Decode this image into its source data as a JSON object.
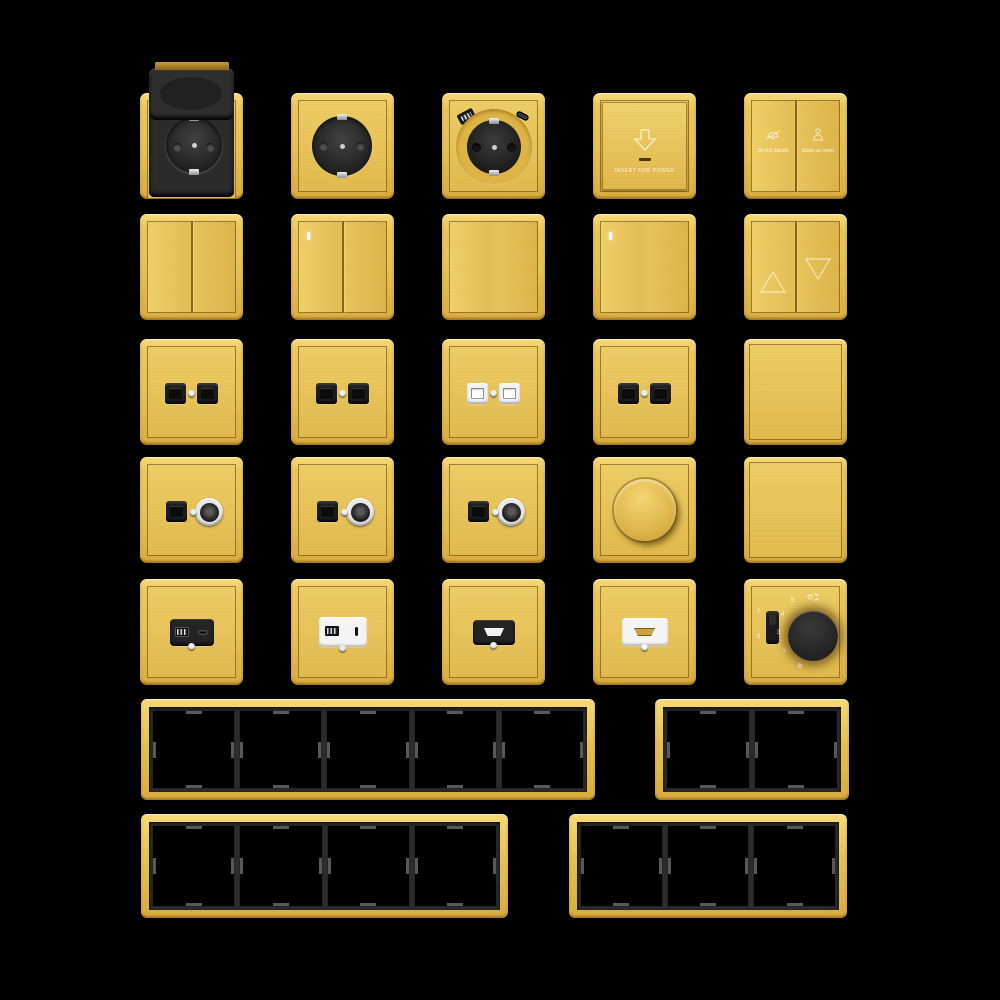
{
  "palette": {
    "background": "#000000",
    "gold": "#E8C355",
    "gold_light": "#F6D977",
    "gold_dark": "#D9AC3E",
    "seam_brown": "#8A6516",
    "module_black": "#242424",
    "module_white": "#F4F4F4",
    "frame_window_black": "#000000",
    "divider_gray": "#585858",
    "indicator_white": "#FFFFFF"
  },
  "icons": {
    "arrow_down": "insert-card down arrow outline",
    "bell_slash": "do-not-disturb icon",
    "maid": "make-up-room icon",
    "triangle_up": "curtain up",
    "triangle_down": "curtain down",
    "fan": "fan symbol",
    "snowflake": "cool symbol"
  },
  "products": [
    {
      "name": "schuko-socket-flip-cover"
    },
    {
      "name": "schuko-socket"
    },
    {
      "name": "schuko-socket-usb-charger"
    },
    {
      "name": "key-card-power-switch",
      "label": "INSERT FOR POWER"
    },
    {
      "name": "service-switch",
      "left_label": "Do not disturb",
      "right_label": "Make up room"
    },
    {
      "name": "rocker-switch-2-gang"
    },
    {
      "name": "rocker-switch-2-gang-indicator"
    },
    {
      "name": "rocker-switch-1-gang"
    },
    {
      "name": "rocker-switch-1-gang-indicator"
    },
    {
      "name": "curtain-blind-switch"
    },
    {
      "name": "data-socket-2-port-black"
    },
    {
      "name": "data-socket-2-port-black"
    },
    {
      "name": "data-socket-2-port-white"
    },
    {
      "name": "data-socket-2-port-black"
    },
    {
      "name": "blank-plate"
    },
    {
      "name": "data-tv-socket"
    },
    {
      "name": "data-tv-socket"
    },
    {
      "name": "data-tv-socket"
    },
    {
      "name": "rotary-dimmer"
    },
    {
      "name": "blank-plate"
    },
    {
      "name": "usb-a-c-charger-black"
    },
    {
      "name": "usb-a-c-charger-white"
    },
    {
      "name": "hdmi-socket-black"
    },
    {
      "name": "hdmi-socket-white"
    },
    {
      "name": "fan-speed-thermostat",
      "slider_on": "1",
      "slider_off": "0",
      "scale": [
        "5",
        "4",
        "3",
        "2"
      ],
      "cool_symbol": "❄"
    },
    {
      "name": "frame-5-gang",
      "gangs": 5
    },
    {
      "name": "frame-2-gang",
      "gangs": 2
    },
    {
      "name": "frame-4-gang",
      "gangs": 4
    },
    {
      "name": "frame-3-gang",
      "gangs": 3
    }
  ]
}
